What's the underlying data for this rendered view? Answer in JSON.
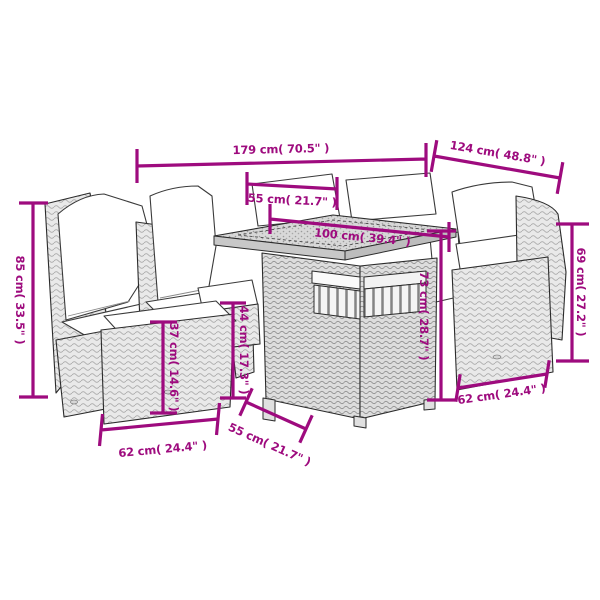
{
  "image": {
    "kind": "product dimension diagram",
    "subject": "6-piece poly rattan garden lounge set: corner chairs with white cushions, ottoman and cube dining table",
    "background_color": "#ffffff",
    "accent_color": "#9E0B7E",
    "sketch_outline_color": "#2b2b2b"
  },
  "dimensions": [
    {
      "id": "overall-width",
      "label": "179 cm( 70.5\" )"
    },
    {
      "id": "overall-depth",
      "label": "124 cm( 48.8\" )"
    },
    {
      "id": "tabletop-width",
      "label": "55 cm( 21.7\" )"
    },
    {
      "id": "tabletop-length",
      "label": "100 cm( 39.4\" )"
    },
    {
      "id": "backrest-height-left",
      "label": "85 cm( 33.5\" )"
    },
    {
      "id": "backrest-height-right",
      "label": "69 cm( 27.2\" )"
    },
    {
      "id": "ottoman-height",
      "label": "37 cm( 14.6\" )"
    },
    {
      "id": "seat-height",
      "label": "44 cm( 17.3\" )"
    },
    {
      "id": "table-height",
      "label": "73 cm( 28.7\" )"
    },
    {
      "id": "seat-width-left",
      "label": "62 cm( 24.4\" )"
    },
    {
      "id": "table-depth",
      "label": "55 cm( 21.7\" )"
    },
    {
      "id": "seat-width-right",
      "label": "62 cm( 24.4\" )"
    }
  ]
}
